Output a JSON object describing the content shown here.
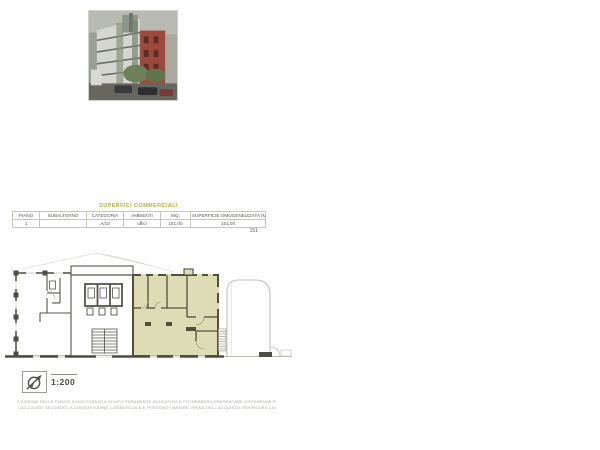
{
  "table": {
    "title": "SUPERFICI COMMERCIALI",
    "title_color": "#b5b53c",
    "headers": [
      "PIANO",
      "SUBALTERNO",
      "CATEGORIA",
      "AMBIENTI",
      "MQ.",
      "SUPERFICIE OMOGENEIZZATA (MQ)"
    ],
    "rows": [
      [
        "1",
        "",
        "A/10",
        "uffici",
        "151,00",
        "151,00"
      ]
    ],
    "total": "151"
  },
  "plan": {
    "scale_label": "1:200",
    "highlight_color": "#dedcb4",
    "wall_color": "#514f41"
  },
  "footer": {
    "line1": "I DISEGNI DELLE PIANTE SONO FORNITI A SCOPO PURAMENTE INDICATIVO E POTREBBERO PRESENTARE DIFFERENZE RISPETTO ALLO STATO DEI LUOGHI. LE SUPERFICI SONO",
    "line2": "CALCOLATE SECONDO LA CONSUETUDINE COMMERCIALE E POSSONO VARIARE. PRIMA DELL'ACQUISTO VERIFICARE LA DOCUMENTAZIONE CATASTALE."
  }
}
